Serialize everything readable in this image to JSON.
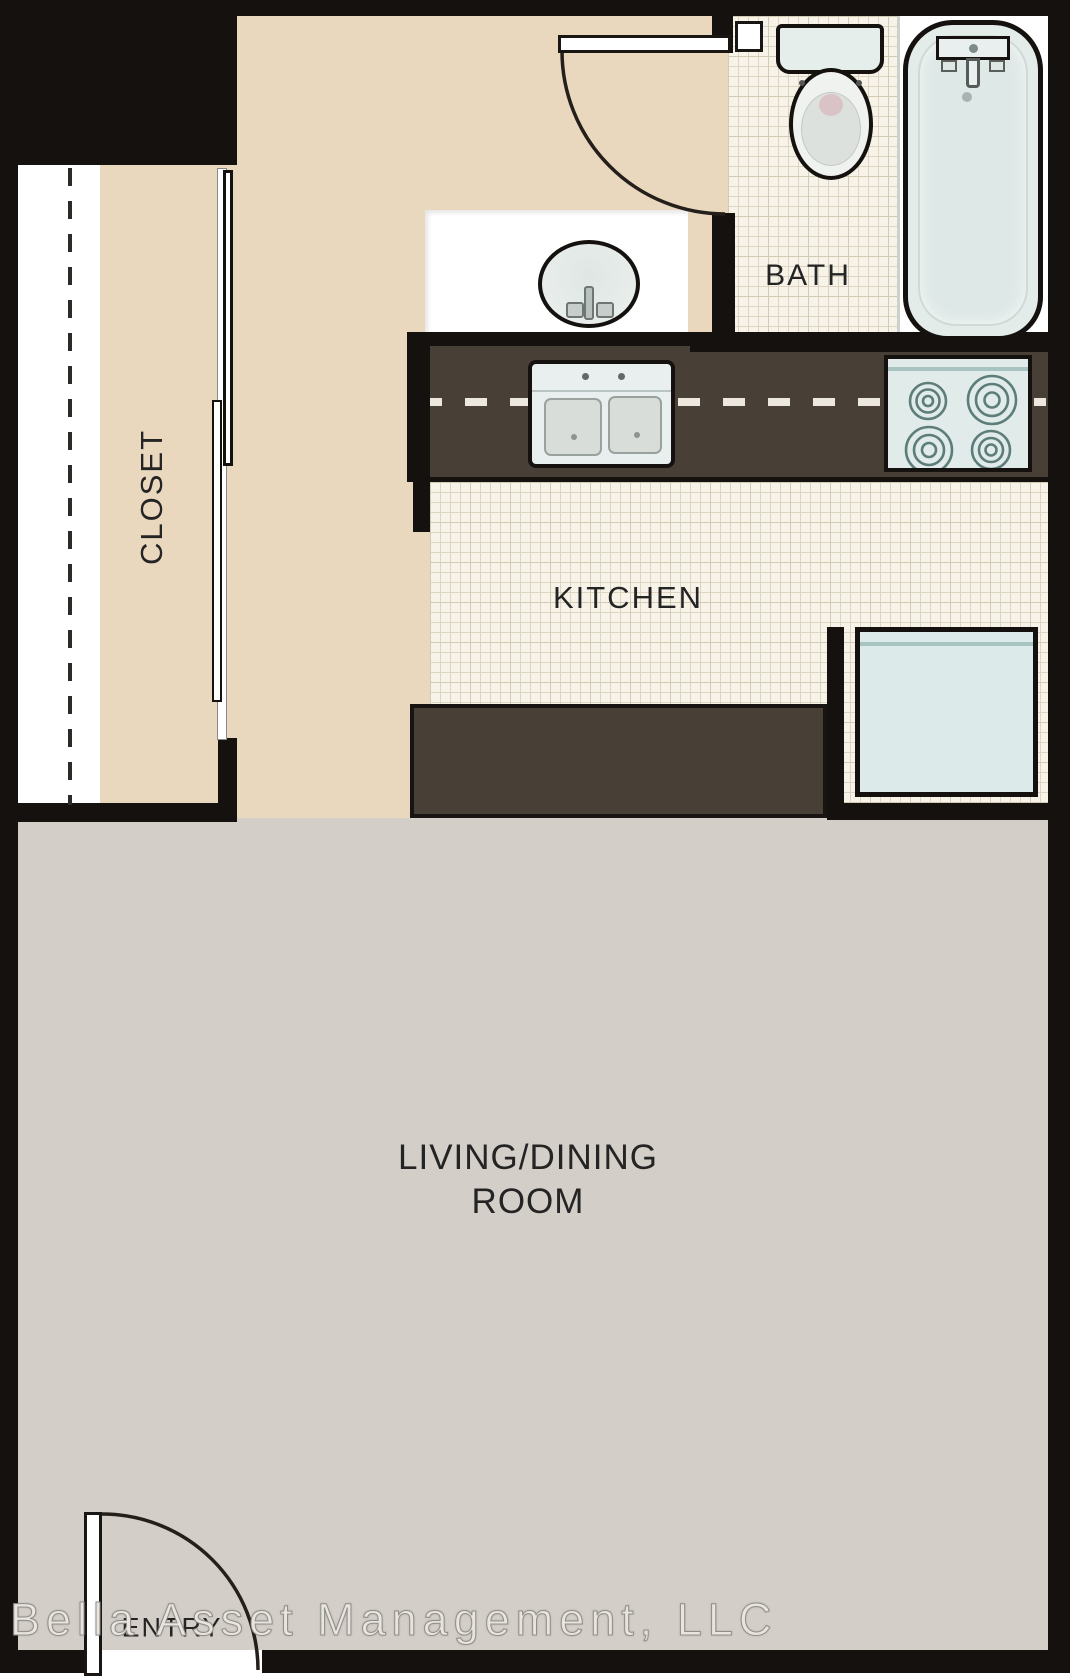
{
  "floorplan": {
    "watermark": "Bella Asset Management, LLC",
    "rooms": {
      "closet": "CLOSET",
      "bath": "BATH",
      "kitchen": "KITCHEN",
      "living_line1": "LIVING/DINING",
      "living_line2": "ROOM",
      "entry": "ENTRY"
    },
    "colors": {
      "wall": "#14110e",
      "hall_floor": "#e9d8bd",
      "living_floor": "#d4cec8",
      "tile_floor": "#f7f3e8",
      "tile_line": "#ddd5c2",
      "counter": "#483f36",
      "appliance_fill": "#e1ebe9",
      "appliance_accent": "#a7c4c0",
      "label_text": "#242424",
      "watermark_text": "#e8e5e1"
    }
  }
}
